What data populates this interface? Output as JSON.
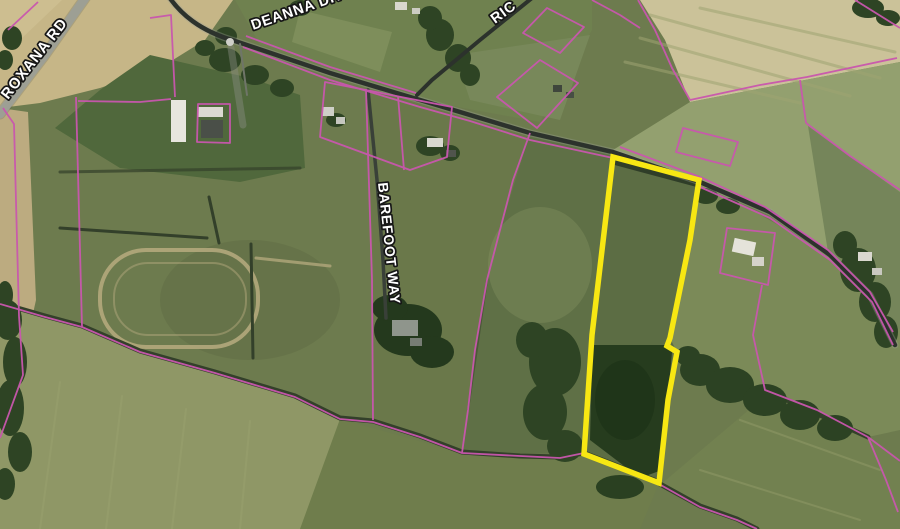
{
  "map": {
    "description": "Aerial satellite parcel map with highlighted property",
    "road_labels": {
      "roxana": "ROXANA RD",
      "deanna": "DEANNA DR",
      "ric": "RIC",
      "barefoot": "BAREFOOT WAY"
    },
    "colors": {
      "highlight_outline": "#f7e713",
      "parcel_line": "#c957ae",
      "road_dark": "#2c322c",
      "road_light": "#b3b5aa",
      "label_text": "#ffffff",
      "label_outline": "#161616"
    }
  }
}
